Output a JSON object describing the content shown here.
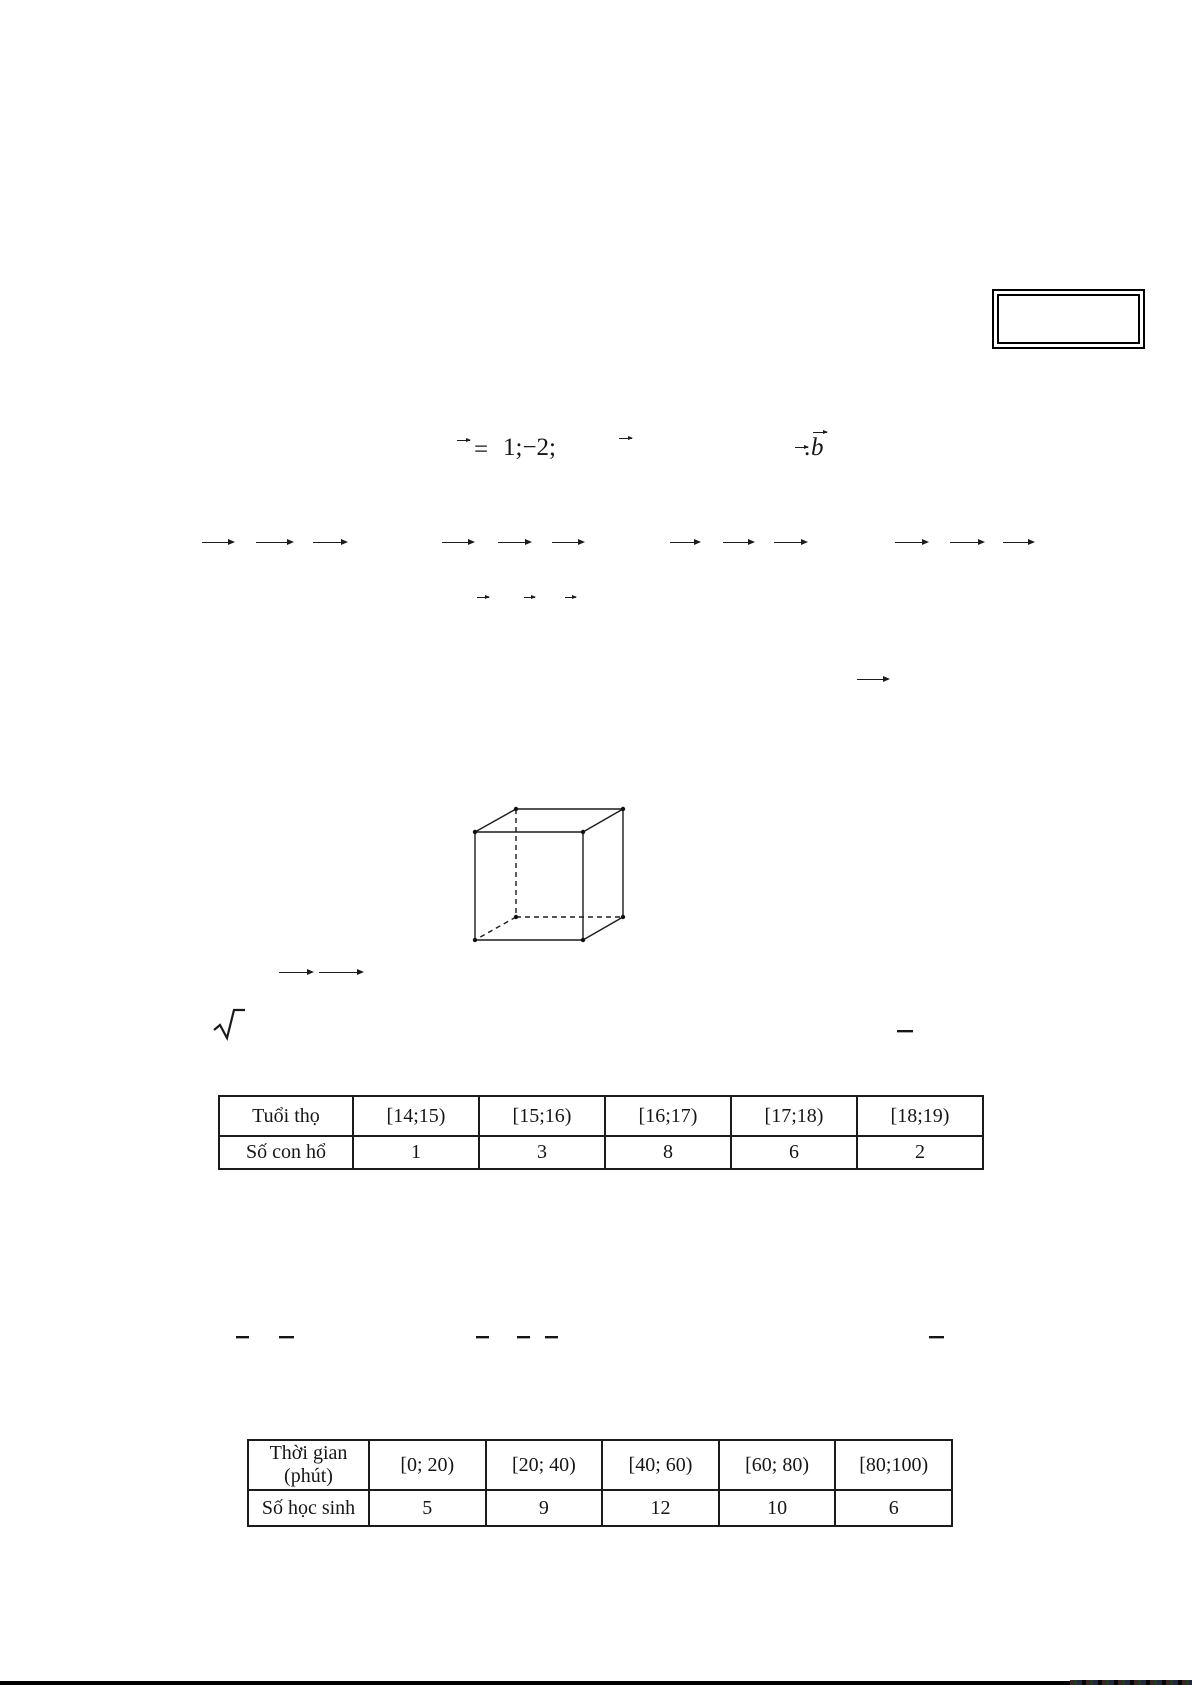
{
  "page": {
    "background": "#ffffff",
    "ink_color": "#1b1b1b"
  },
  "formula_line": {
    "equals": "=",
    "coords_fragment": "1;−2;",
    "dot": ".",
    "b_symbol": "b"
  },
  "icons": {
    "vector_arrow": "long right arrow used as vector overline",
    "vector_hat": "short right arrow used as vector hat",
    "radical": "√"
  },
  "tables": [
    {
      "name": "lifespan-frequency-table",
      "row1_header": "Tuổi thọ",
      "row2_header": "Số con hổ",
      "intervals": [
        "[14;15)",
        "[15;16)",
        "[16;17)",
        "[17;18)",
        "[18;19)"
      ],
      "counts": [
        "1",
        "3",
        "8",
        "6",
        "2"
      ]
    },
    {
      "name": "time-frequency-table",
      "row1_header": "Thời gian",
      "row1_header_sub": "(phút)",
      "row2_header": "Số học sinh",
      "intervals": [
        "[0; 20)",
        "[20; 40)",
        "[40; 60)",
        "[60; 80)",
        "[80;100)"
      ],
      "counts": [
        "5",
        "9",
        "12",
        "10",
        "6"
      ]
    }
  ]
}
